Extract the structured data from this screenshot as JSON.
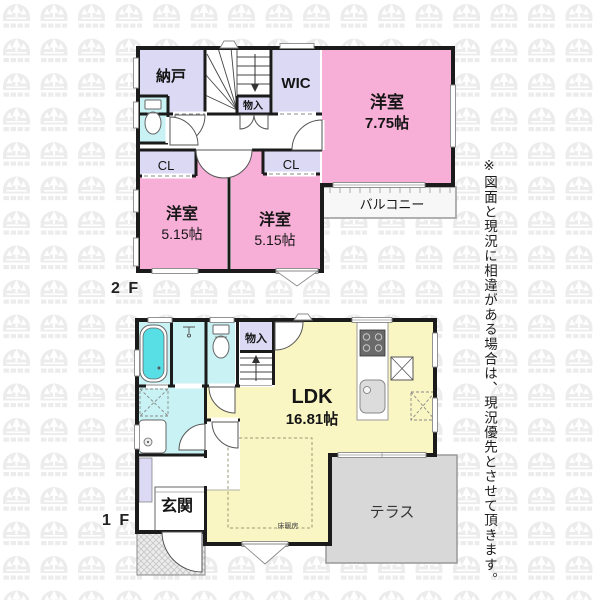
{
  "disclaimer": "※図面と現況に相違がある場合は、現況優先とさせて頂きます。",
  "floor2": {
    "label": "2 F",
    "nando": "納戸",
    "wic": "WIC",
    "monoire": "物入",
    "main_room_name": "洋室",
    "main_room_size": "7.75帖",
    "cl_left": "CL",
    "cl_right": "CL",
    "left_room_name": "洋室",
    "left_room_size": "5.15帖",
    "mid_room_name": "洋室",
    "mid_room_size": "5.15帖",
    "balcony": "バルコニー"
  },
  "floor1": {
    "label": "1 F",
    "ldk_name": "LDK",
    "ldk_size": "16.81帖",
    "monoire": "物入",
    "genkan": "玄関",
    "terrace": "テラス",
    "floor_heating": "床暖房"
  },
  "colors": {
    "wall": "#1b1b1b",
    "room_pink": "#F8AFD7",
    "room_lavender": "#DBD9F4",
    "room_cyan": "#C9F2F4",
    "bathtub": "#58DFE6",
    "ldk_yellow": "#FAF6C3",
    "terrace_gray": "#D8D8D8",
    "balcony_white": "#F7F7F7",
    "watermark_gray": "#ECECEC"
  }
}
